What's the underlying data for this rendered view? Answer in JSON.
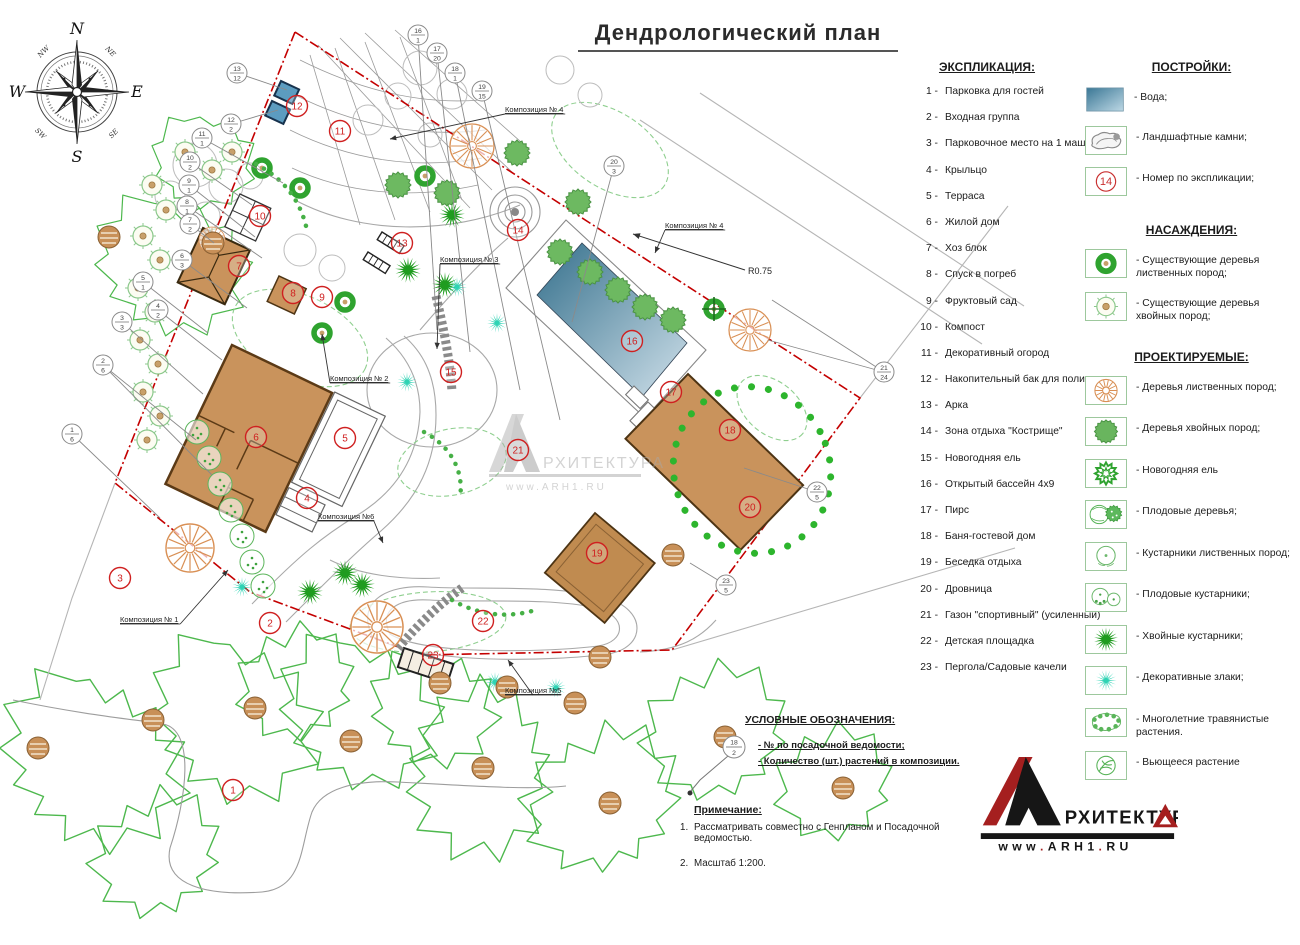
{
  "title": "Дендрологический  план",
  "compass": {
    "n": "N",
    "e": "E",
    "s": "S",
    "w": "W",
    "ne": "NE",
    "se": "SE",
    "sw": "SW",
    "nw": "NW"
  },
  "explication": {
    "heading": "ЭКСПЛИКАЦИЯ:",
    "separator": "-",
    "items": [
      {
        "num": "1",
        "label": "Парковка для гостей"
      },
      {
        "num": "2",
        "label": "Входная группа"
      },
      {
        "num": "3",
        "label": "Парковочное место на 1 машину"
      },
      {
        "num": "4",
        "label": "Крыльцо"
      },
      {
        "num": "5",
        "label": "Терраса"
      },
      {
        "num": "6",
        "label": "Жилой дом"
      },
      {
        "num": "7",
        "label": "Хоз блок"
      },
      {
        "num": "8",
        "label": "Спуск  в погреб"
      },
      {
        "num": "9",
        "label": "Фруктовый сад"
      },
      {
        "num": "10",
        "label": "Компост"
      },
      {
        "num": "11",
        "label": "Декоративный огород"
      },
      {
        "num": "12",
        "label": "Накопительный бак для полива"
      },
      {
        "num": "13",
        "label": "Арка"
      },
      {
        "num": "14",
        "label": "Зона отдыха \"Кострище\""
      },
      {
        "num": "15",
        "label": "Новогодняя ель"
      },
      {
        "num": "16",
        "label": "Открытый бассейн 4х9"
      },
      {
        "num": "17",
        "label": "Пирс"
      },
      {
        "num": "18",
        "label": "Баня-гостевой дом"
      },
      {
        "num": "19",
        "label": "Беседка отдыха"
      },
      {
        "num": "20",
        "label": "Дровница"
      },
      {
        "num": "21",
        "label": "Газон \"спортивный\" (усиленный)"
      },
      {
        "num": "22",
        "label": "Детская площадка"
      },
      {
        "num": "23",
        "label": "Пергола/Садовые качели"
      }
    ]
  },
  "legend_buildings": {
    "heading": "ПОСТРОЙКИ:",
    "items": [
      {
        "icon": "water",
        "label": "-   Вода;"
      },
      {
        "icon": "landscape-stones",
        "label": "-   Ландшафтные камни;"
      },
      {
        "icon": "explication-number",
        "label": "-   Номер по экспликации;",
        "number": "14"
      }
    ]
  },
  "legend_plantings": {
    "heading": "НАСАЖДЕНИЯ:",
    "items": [
      {
        "icon": "existing-deciduous-tree",
        "label": "-   Существующие деревья лиственных пород;"
      },
      {
        "icon": "existing-conifer-tree",
        "label": "-   Существующие деревья хвойных пород;"
      }
    ]
  },
  "legend_projected": {
    "heading": "ПРОЕКТИРУЕМЫЕ:",
    "items": [
      {
        "icon": "deciduous-tree",
        "label": "-   Деревья лиственных пород;"
      },
      {
        "icon": "conifer-tree",
        "label": "-   Деревья хвойных пород;"
      },
      {
        "icon": "new-year-spruce",
        "label": "- Новогодняя ель"
      },
      {
        "icon": "fruit-trees",
        "label": "-   Плодовые деревья;"
      },
      {
        "icon": "deciduous-shrub",
        "label": "-  Кустарники лиственных пород;"
      },
      {
        "icon": "fruit-shrubs",
        "label": "-   Плодовые кустарники;"
      },
      {
        "icon": "conifer-shrub",
        "label": "-   Хвойные кустарники;"
      },
      {
        "icon": "ornamental-grass",
        "label": "-   Декоративные злаки;"
      },
      {
        "icon": "perennial-plants",
        "label": "-   Многолетние травянистые растения."
      },
      {
        "icon": "climbing-plant",
        "label": "-  Вьющееся растение"
      }
    ]
  },
  "symbols": {
    "heading": "УСЛОВНЫЕ ОБОЗНАЧЕНИЯ:",
    "circle_top": "18",
    "circle_bottom": "2",
    "line1": "-  № по посадочной ведомости;",
    "line2": "-  Количество (шт.) растений в композиции."
  },
  "notes": {
    "heading": "Примечание:",
    "items": [
      {
        "num": "1.",
        "text": "Рассматривать совместно с Генпланом и Посадочной ведомостью."
      },
      {
        "num": "2.",
        "text": "Масштаб 1:200."
      }
    ]
  },
  "logo": {
    "glyph": "А",
    "name_rest": "РХИТЕКТУР",
    "name_end": "А",
    "url": "www.ARH1.RU"
  },
  "watermark": {
    "name": "РХИТЕКТУРА",
    "url": "www.ARH1.RU"
  },
  "plan": {
    "r_label": "R0.75",
    "markers": [
      {
        "n": "1",
        "x": 233,
        "y": 790
      },
      {
        "n": "2",
        "x": 270,
        "y": 623
      },
      {
        "n": "3",
        "x": 120,
        "y": 578
      },
      {
        "n": "4",
        "x": 307,
        "y": 498
      },
      {
        "n": "5",
        "x": 345,
        "y": 438
      },
      {
        "n": "6",
        "x": 256,
        "y": 437
      },
      {
        "n": "7",
        "x": 239,
        "y": 266
      },
      {
        "n": "8",
        "x": 293,
        "y": 293
      },
      {
        "n": "9",
        "x": 322,
        "y": 297
      },
      {
        "n": "10",
        "x": 260,
        "y": 216
      },
      {
        "n": "11",
        "x": 340,
        "y": 131
      },
      {
        "n": "12",
        "x": 297,
        "y": 106
      },
      {
        "n": "13",
        "x": 402,
        "y": 243
      },
      {
        "n": "14",
        "x": 518,
        "y": 230
      },
      {
        "n": "15",
        "x": 451,
        "y": 372
      },
      {
        "n": "16",
        "x": 632,
        "y": 341
      },
      {
        "n": "17",
        "x": 671,
        "y": 392
      },
      {
        "n": "18",
        "x": 730,
        "y": 430
      },
      {
        "n": "19",
        "x": 597,
        "y": 553
      },
      {
        "n": "20",
        "x": 750,
        "y": 507
      },
      {
        "n": "21",
        "x": 518,
        "y": 450
      },
      {
        "n": "22",
        "x": 483,
        "y": 621
      },
      {
        "n": "23",
        "x": 433,
        "y": 655
      }
    ],
    "callouts": [
      {
        "t": "13",
        "b": "12",
        "x": 237,
        "y": 73,
        "lx": 287,
        "ly": 90
      },
      {
        "t": "12",
        "b": "2",
        "x": 231,
        "y": 124,
        "lx": 278,
        "ly": 110
      },
      {
        "t": "11",
        "b": "1",
        "x": 202,
        "y": 138,
        "lx": 283,
        "ly": 183
      },
      {
        "t": "10",
        "b": "2",
        "x": 190,
        "y": 162,
        "lx": 252,
        "ly": 205
      },
      {
        "t": "9",
        "b": "1",
        "x": 189,
        "y": 185,
        "lx": 255,
        "ly": 237
      },
      {
        "t": "8",
        "b": "1",
        "x": 187,
        "y": 206,
        "lx": 262,
        "ly": 258
      },
      {
        "t": "7",
        "b": "2",
        "x": 190,
        "y": 224,
        "lx": 214,
        "ly": 243
      },
      {
        "t": "6",
        "b": "3",
        "x": 182,
        "y": 260,
        "lx": 247,
        "ly": 308
      },
      {
        "t": "5",
        "b": "1",
        "x": 143,
        "y": 282,
        "lx": 208,
        "ly": 333
      },
      {
        "t": "4",
        "b": "2",
        "x": 158,
        "y": 310,
        "lx": 222,
        "ly": 360
      },
      {
        "t": "3",
        "b": "3",
        "x": 122,
        "y": 322,
        "lx": 203,
        "ly": 394
      },
      {
        "t": "2",
        "b": "6",
        "x": 103,
        "y": 365,
        "lx": 196,
        "ly": 440,
        "l2x": 212,
        "l2y": 475
      },
      {
        "t": "1",
        "b": "6",
        "x": 72,
        "y": 434,
        "lx": 160,
        "ly": 518
      },
      {
        "t": "16",
        "b": "1",
        "x": 418,
        "y": 35,
        "lx": 437,
        "ly": 330
      },
      {
        "t": "17",
        "b": "20",
        "x": 437,
        "y": 53,
        "lx": 470,
        "ly": 352
      },
      {
        "t": "18",
        "b": "1",
        "x": 455,
        "y": 73,
        "lx": 520,
        "ly": 390
      },
      {
        "t": "19",
        "b": "15",
        "x": 482,
        "y": 91,
        "lx": 560,
        "ly": 420
      },
      {
        "t": "20",
        "b": "3",
        "x": 614,
        "y": 166,
        "lx": 572,
        "ly": 322
      },
      {
        "t": "21",
        "b": "24",
        "x": 884,
        "y": 372,
        "lx": 772,
        "ly": 300,
        "l2x": 768,
        "l2y": 340
      },
      {
        "t": "22",
        "b": "5",
        "x": 817,
        "y": 492,
        "lx": 744,
        "ly": 468
      },
      {
        "t": "23",
        "b": "5",
        "x": 726,
        "y": 585,
        "lx": 690,
        "ly": 563
      }
    ],
    "compositions": [
      {
        "label": "Композиция № 4",
        "x": 505,
        "y": 112,
        "tx": 390,
        "ty": 139
      },
      {
        "label": "Композиция № 4",
        "x": 665,
        "y": 228,
        "tx": 655,
        "ty": 253
      },
      {
        "label": "Композиция № 3",
        "x": 440,
        "y": 262,
        "tx": 437,
        "ty": 349
      },
      {
        "label": "Композиция № 2",
        "x": 330,
        "y": 381,
        "tx": 322,
        "ty": 334
      },
      {
        "label": "Композиция №6",
        "x": 318,
        "y": 519,
        "tx": 383,
        "ty": 543
      },
      {
        "label": "Композиция № 1",
        "x": 120,
        "y": 622,
        "tx": 228,
        "ty": 570
      },
      {
        "label": "Композиция №5",
        "x": 505,
        "y": 693,
        "tx": 508,
        "ty": 660
      }
    ]
  }
}
